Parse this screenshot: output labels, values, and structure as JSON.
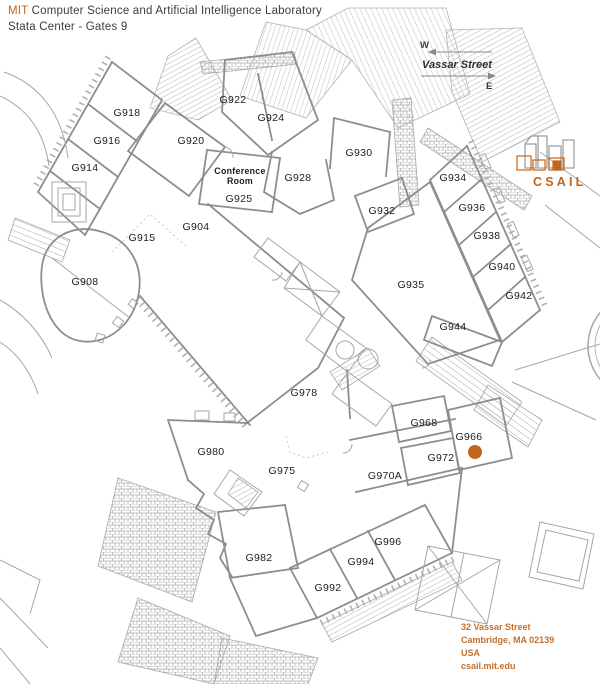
{
  "header": {
    "brand": "MIT",
    "title": "Computer Science and Artificial Intelligence Laboratory",
    "subtitle": "Stata Center - Gates 9"
  },
  "compass": {
    "west_label": "W",
    "east_label": "E",
    "street": "Vassar Street"
  },
  "logo": {
    "wordmark": "CSAIL"
  },
  "marker": {
    "room": "G966",
    "x": 475,
    "y": 452,
    "radius": 7,
    "color": "#c4641a"
  },
  "address": {
    "lines": [
      "32 Vassar Street",
      "Cambridge, MA 02139",
      "USA",
      "csail.mit.edu"
    ]
  },
  "colors": {
    "accent": "#c4641a",
    "wall": "#8d8d8d",
    "secondary_line": "#a6a6a6",
    "faint_line": "#c8c8c8",
    "label_text": "#1c1c1c",
    "title_text": "#3d3d3d"
  },
  "rooms": [
    {
      "label": "G918",
      "x": 127,
      "y": 116
    },
    {
      "label": "G916",
      "x": 107,
      "y": 144
    },
    {
      "label": "G914",
      "x": 85,
      "y": 171
    },
    {
      "label": "G920",
      "x": 191,
      "y": 144
    },
    {
      "label": "G922",
      "x": 233,
      "y": 103
    },
    {
      "label": "G924",
      "x": 271,
      "y": 121
    },
    {
      "label": "G928",
      "x": 298,
      "y": 181
    },
    {
      "label": "G930",
      "x": 359,
      "y": 156
    },
    {
      "label": "Conference Room",
      "x": 240,
      "y": 174,
      "lines": [
        "Conference",
        "Room"
      ]
    },
    {
      "label": "G925",
      "x": 239,
      "y": 202
    },
    {
      "label": "G904",
      "x": 196,
      "y": 230
    },
    {
      "label": "G915",
      "x": 142,
      "y": 241
    },
    {
      "label": "G908",
      "x": 85,
      "y": 285
    },
    {
      "label": "G934",
      "x": 453,
      "y": 181
    },
    {
      "label": "G936",
      "x": 472,
      "y": 211
    },
    {
      "label": "G932",
      "x": 382,
      "y": 214
    },
    {
      "label": "G938",
      "x": 487,
      "y": 239
    },
    {
      "label": "G940",
      "x": 502,
      "y": 270
    },
    {
      "label": "G942",
      "x": 519,
      "y": 299
    },
    {
      "label": "G935",
      "x": 411,
      "y": 288
    },
    {
      "label": "G944",
      "x": 453,
      "y": 330
    },
    {
      "label": "G978",
      "x": 304,
      "y": 396
    },
    {
      "label": "G980",
      "x": 211,
      "y": 455
    },
    {
      "label": "G975",
      "x": 282,
      "y": 474
    },
    {
      "label": "G968",
      "x": 424,
      "y": 426
    },
    {
      "label": "G966",
      "x": 469,
      "y": 440
    },
    {
      "label": "G972",
      "x": 441,
      "y": 461
    },
    {
      "label": "G970A",
      "x": 385,
      "y": 479
    },
    {
      "label": "G982",
      "x": 259,
      "y": 561
    },
    {
      "label": "G992",
      "x": 328,
      "y": 591
    },
    {
      "label": "G994",
      "x": 361,
      "y": 565
    },
    {
      "label": "G996",
      "x": 388,
      "y": 545
    }
  ]
}
